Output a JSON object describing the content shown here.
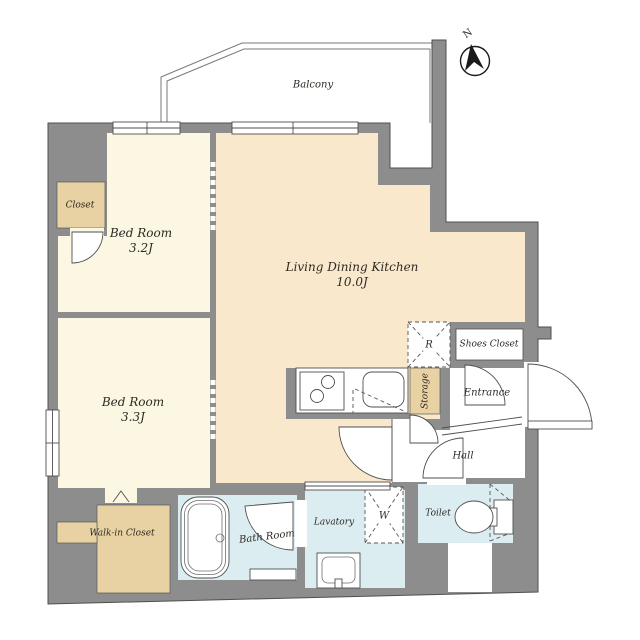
{
  "compass": {
    "north_label": "N"
  },
  "rooms": {
    "balcony": {
      "label": "Balcony"
    },
    "bedroom_1": {
      "name": "Bed Room",
      "area": "3.2J"
    },
    "bedroom_2": {
      "name": "Bed Room",
      "area": "3.3J"
    },
    "ldk": {
      "name": "Living Dining Kitchen",
      "area": "10.0J"
    },
    "closet": {
      "label": "Closet"
    },
    "walk_in_closet": {
      "label": "Walk-in Closet"
    },
    "shoes_closet": {
      "label": "Shoes Closet"
    },
    "entrance": {
      "label": "Entrance"
    },
    "hall": {
      "label": "Hall"
    },
    "storage": {
      "label": "Storage"
    },
    "bath_room": {
      "label": "Bath Room"
    },
    "lavatory": {
      "label": "Lavatory"
    },
    "toilet": {
      "label": "Toilet"
    }
  },
  "appliances": {
    "refrigerator": {
      "label": "R"
    },
    "washing_machine": {
      "label": "W"
    }
  },
  "colors": {
    "wall": "#8d8d8d",
    "bedroom": "#fbf7e2",
    "ldk": "#fae8cc",
    "closet": "#e8d1a2",
    "wet": "#dcedf2",
    "line": "#4f4f4f"
  }
}
